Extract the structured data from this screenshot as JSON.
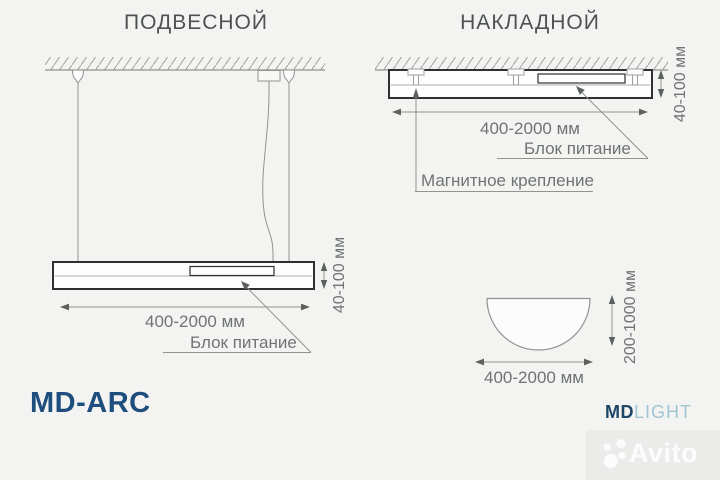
{
  "colors": {
    "background": "#f3f4f2",
    "line": "#8f948f",
    "dark_line": "#2e2f2e",
    "dim_text": "#6f7472",
    "title_text": "#4d5250",
    "model_text": "#1d4e7e",
    "brand_md": "#1d4566",
    "brand_light": "#a2c5d3",
    "watermark": "#ffffff"
  },
  "left_panel": {
    "title": "ПОДВЕСНОЙ",
    "width_dim": "400-2000 мм",
    "height_dim": "40-100 мм",
    "power_label": "Блок питание"
  },
  "right_panel": {
    "title": "НАКЛАДНОЙ",
    "width_dim": "400-2000 мм",
    "height_dim": "40-100 мм",
    "power_label": "Блок питание",
    "magnet_label": "Магнитное крепление"
  },
  "arc_view": {
    "width_dim": "400-2000 мм",
    "height_dim": "200-1000 мм"
  },
  "footer": {
    "model": "MD-ARC",
    "brand_md": "MD",
    "brand_light": "LIGHT"
  },
  "watermark": {
    "text": "Avito"
  }
}
